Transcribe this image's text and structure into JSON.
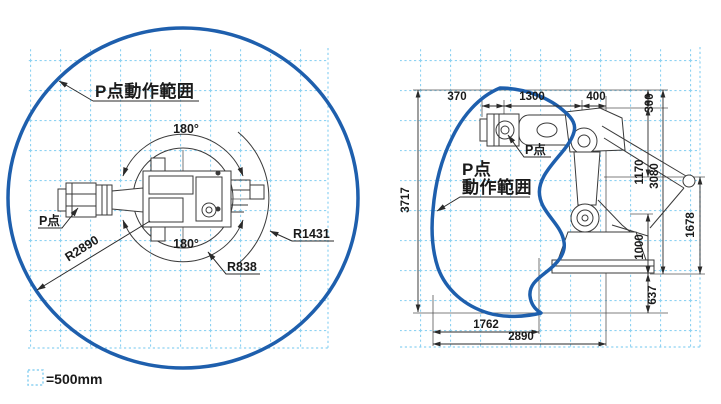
{
  "colors": {
    "range_outline": "#1e5fad",
    "grid": "#8ed2f2",
    "line_art": "#3a3a3a",
    "text": "#1a1a1a"
  },
  "legend": {
    "scale_text": "=500mm"
  },
  "left_view": {
    "range_label": "P点動作範囲",
    "p_point_label": "P点",
    "angle_top": "180°",
    "angle_bottom": "180°",
    "radius_reach": "R2890",
    "radius_inner": "R838",
    "radius_mid": "R1431"
  },
  "right_view": {
    "range_label_line1": "P点",
    "range_label_line2": "動作範囲",
    "p_point_label": "P点",
    "dim_top_370": "370",
    "dim_top_1300": "1300",
    "dim_top_400": "400",
    "dim_left_3717": "3717",
    "dim_right_300": "300",
    "dim_right_1170": "1170",
    "dim_right_3080": "3080",
    "dim_right_1000": "1000",
    "dim_right_1678": "1678",
    "dim_right_637": "637",
    "dim_bottom_1762": "1762",
    "dim_bottom_2890": "2890"
  }
}
